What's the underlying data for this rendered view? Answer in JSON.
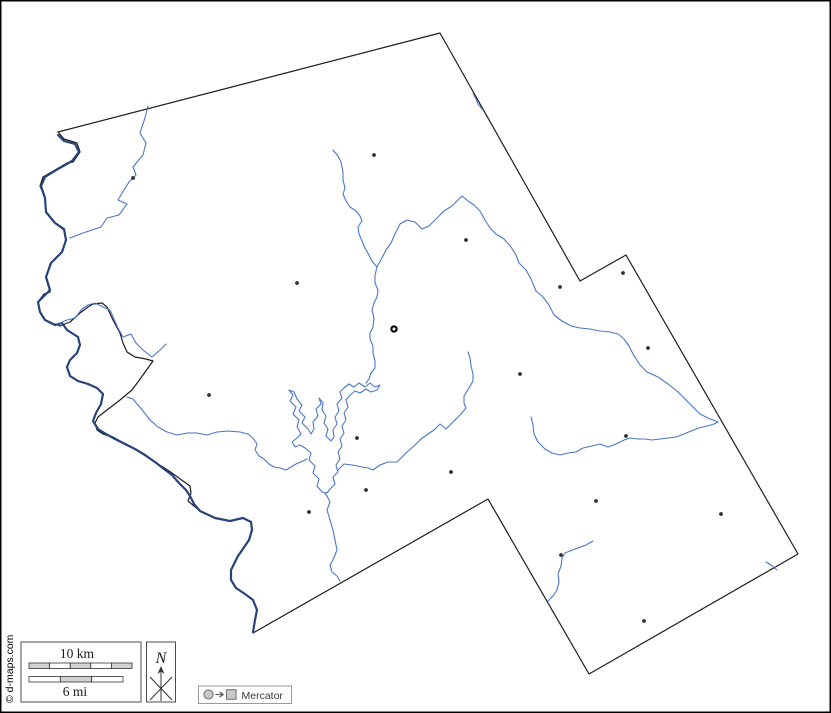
{
  "canvas": {
    "width": 831,
    "height": 713,
    "background": "#ffffff"
  },
  "copyright": "© d-maps.com",
  "legend": {
    "scale": {
      "km_label": "10 km",
      "mi_label": "6 mi",
      "km_bar": {
        "x": 29,
        "y": 663,
        "height": 5.5,
        "segment_width": 20.6,
        "segments": [
          "#cdd2d6",
          "#ffffff",
          "#cdd2d6",
          "#ffffff",
          "#cdd2d6"
        ]
      },
      "mi_bar": {
        "x": 29,
        "y": 676.5,
        "height": 5.5,
        "segment_width": 31.33,
        "segments": [
          "#ffffff",
          "#cdd2d6",
          "#ffffff"
        ]
      }
    },
    "north": {
      "label": "N"
    },
    "projection": {
      "label": "Mercator"
    }
  },
  "colors": {
    "frame": "#000000",
    "boundary": "#1c1c1c",
    "river_thin": "#4a76c8",
    "river_thick": "#27437a",
    "town": "#2f2f2f",
    "seat_ring": "#111111",
    "box_border_dark": "#4d4d4d",
    "box_border_light": "#9a9a9a",
    "symbol_fill": "#c9c9c9",
    "symbol_stroke": "#6e6e6e",
    "legend_text": "#3a3a3a",
    "copyright_text": "#2e2e2e"
  },
  "map": {
    "boundary_path": "M58,132 L440,33 L580,281 L626,255 L798,554 L589,674 L488,499 L253,633 L255,620 L257,610 L253,600 L245,594 L236,588 L231,580 L231,570 L238,556 L249,540 L252,530 L251,522 L243,518 L230,521 L215,518 L200,511 L188,501 L191,493 L190,486 L183,481 L172,473 L163,467 L156,463 L147,457 L138,451 L130,446 L122,442 L113,437 L103,434 L97,430 L95,423 L98,417 L107,410 L120,400 L132,390 L143,375 L153,361 L146,359 L135,357 L127,352 L123,343 L120,333 L113,320 L107,307 L102,303 L93,304 L88,307 L80,313 L70,322 L60,326 L52,323 L45,320 L40,312 L38,302 L44,294 L50,292 L46,278 L50,264 L62,252 L66,240 L64,230 L56,224 L46,212 L45,198 L40,186 L43,177 L55,170 L67,163 L73,162 L80,152 L77,143 L64,139 Z",
    "main_river_path": "M58,135 L64,141 L75,144 L79,152 L72,161 L58,169 L45,177 L41,186 L45,198 L46,212 L55,223 L64,229 L66,240 L62,252 L51,263 L46,277 L50,290 L44,296 L38,302 L40,312 L45,320 L55,325 L62,323 L67,330 L78,337 L80,345 L77,353 L70,360 L67,367 L70,376 L78,381 L88,384 L97,388 L103,394 L101,404 L96,413 L93,421 L98,429 L106,434 L115,439 L125,444 L135,449 L145,455 L155,462 L164,469 L172,475 L179,483 L186,490 L190,496 L194,504 L200,511 L215,518 L230,521 L243,518 L251,522 L252,530 L249,540 L238,556 L231,570 L231,580 L236,588 L245,594 L253,600 L257,610 L255,620 L253,632",
    "lake_path": "M322,492 L317,486 L319,479 L313,473 L315,466 L309,460 L311,453 L305,448 L300,445 L295,447 L292,442 L297,438 L301,434 L297,427 L299,420 L293,414 L296,407 L290,401 L293,395 L289,390 L294,392 L297,399 L302,405 L299,411 L305,417 L302,423 L308,429 L311,434 L314,429 L313,422 L318,416 L316,409 L321,404 L319,398 L323,403 L322,410 L326,416 L324,423 L328,429 L326,436 L331,441 L334,437 L333,430 L337,424 L335,417 L339,411 L337,404 L342,398 L340,392 L345,387 L349,384 L354,387 L359,383 L365,387 L370,383 L375,387 L380,385 L377,390 L371,392 L366,389 L360,393 L355,391 L350,395 L346,400 L348,407 L344,413 L346,420 L342,426 L344,433 L340,439 L342,446 L338,452 L340,459 L336,465 L338,472 L333,477 L335,484 L330,489 L327,493 Z",
    "rivers": [
      "M148,106 L145,118 L140,133 L146,143 L143,155 L133,167 L136,175 L129,182 L124,190 L118,200 L127,204 L119,215 L107,218 L101,227 L83,233 L70,238",
      "M60,323 L67,320 L75,318 L82,309 L88,305 L95,303 L103,307 L110,310 L114,319 L118,328 L123,337 L131,334 L136,343 L143,350 L152,357 L160,350 L166,344",
      "M127,397 L133,399 L138,405 L143,411 L150,420 L158,427 L167,432 L177,435 L187,433 L197,433 L207,435 L217,432 L228,431 L240,432 L248,434 L253,438 L257,444 L255,450 L259,456 L264,459 L269,464 L274,467 L280,468 L286,470 L291,467 L296,464 L303,461 L307,459",
      "M333,150 L338,156 L341,162 L343,172 L343,180 L345,188 L343,194 L346,201 L350,207 L356,211 L360,216 L362,221 L358,227 L359,234 L362,241 L365,248 L369,255 L372,261 L377,267 L375,275 L375,283 L378,290 L377,297 L374,303 L372,310 L374,318 L373,327 L370,333 L370,339 L373,346 L373,353 L375,361 L375,368 L371,373 L369,379 L366,383",
      "M462,196 L452,206 L444,211 L436,219 L429,226 L422,229 L415,222 L407,220 L400,224 L396,232 L391,243 L386,250 L382,258 L377,267",
      "M462,196 L468,201 L474,205 L480,211 L485,220 L490,228 L496,234 L504,239 L511,247 L516,255 L519,263 L526,270 L531,279 L536,291 L543,297 L549,305 L554,315 L562,321 L571,326 L580,328 L590,329 L600,331 L610,332 L618,334 L624,339 L629,346 L633,354 L640,365 L647,372 L658,377 L668,384 L678,392 L686,400 L694,408 L700,414 L708,418 L718,422",
      "M531,417 L533,425 L534,434 L538,442 L545,449 L552,453 L560,455 L568,453 L576,452 L583,448 L592,446 L600,444 L608,447 L616,444 L624,440 L630,438 L638,439 L645,439 L652,440 L660,439 L668,438 L676,437 L684,434 L691,431 L699,428 L707,426 L714,424 L718,422",
      "M468,352 L470,358 L471,366 L473,374 L473,381 L469,388 L464,396 L464,403 L466,408 L461,414 L455,420 L450,425 L446,429 L440,424 L434,430 L428,434 L421,439 L414,446 L407,452 L402,457 L397,462 L388,462 L380,465 L373,470 L368,468 L362,467 L352,465 L344,464 L338,470",
      "M593,541 L586,545 L578,548 L570,551 L565,553 L562,558 L561,566 L558,574 L559,582 L557,590 L553,596 L548,601",
      "M324,492 L327,496 L330,502 L327,510 L330,520 L333,530 L335,540 L337,550 L333,560 L330,565 L332,572 L337,576 L340,581",
      "M473,93 L476,99 L478,104 L482,109",
      "M766,562 L771,565 L777,570"
    ],
    "towns": [
      [
        374,
        155
      ],
      [
        466,
        240
      ],
      [
        133,
        178
      ],
      [
        209,
        395
      ],
      [
        297,
        283
      ],
      [
        560,
        287
      ],
      [
        623,
        273
      ],
      [
        648,
        348
      ],
      [
        520,
        374
      ],
      [
        626,
        436
      ],
      [
        451,
        472
      ],
      [
        357,
        438
      ],
      [
        366,
        490
      ],
      [
        309,
        512
      ],
      [
        596,
        501
      ],
      [
        721,
        514
      ],
      [
        561,
        555
      ],
      [
        644,
        621
      ]
    ],
    "county_seat": {
      "x": 394,
      "y": 329
    }
  }
}
